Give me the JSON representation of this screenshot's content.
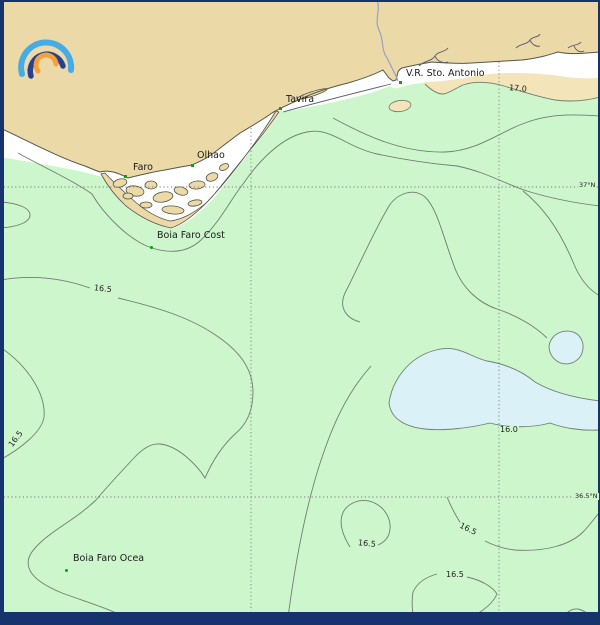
{
  "map": {
    "places": [
      {
        "name": "Faro"
      },
      {
        "name": "Olhao"
      },
      {
        "name": "Tavira"
      },
      {
        "name": "V.R. Sto. Antonio"
      },
      {
        "name": "Boia Faro Cost"
      },
      {
        "name": "Boia Faro Ocea"
      }
    ],
    "contour_labels": [
      {
        "value": "16.5"
      },
      {
        "value": "17.0"
      },
      {
        "value": "16.5"
      },
      {
        "value": "16.0"
      },
      {
        "value": "16.5"
      },
      {
        "value": "16.5"
      },
      {
        "value": "16.5"
      }
    ],
    "latitude_labels": [
      {
        "text": "37°N"
      },
      {
        "text": "36.5°N"
      }
    ],
    "colors": {
      "land": "#ecd9a8",
      "sea": "#cdf6cc",
      "surf_zone": "#ffffff",
      "warm_water": "#f4e4ba",
      "cold_water": "#d9f1f7",
      "frame": "#17336e",
      "contour_line": "#6f7e6f",
      "marker_green": "#0da10d",
      "logo_blue": "#47ace6",
      "logo_navy": "#2b3e92",
      "logo_orange": "#f2a23a"
    },
    "logo_icon": "rainbow-arc-logo"
  }
}
